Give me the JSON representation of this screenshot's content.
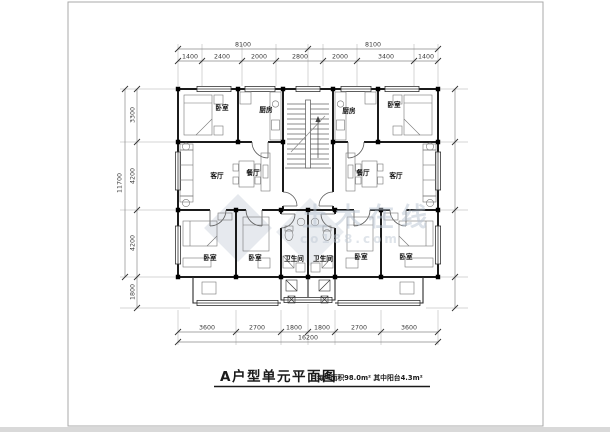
{
  "title": {
    "main": "A户型单元平面图",
    "note": "每户面积98.0m² 其中阳台4.3m²"
  },
  "watermark": {
    "brand": "土木在线",
    "site": "co188.com"
  },
  "dims": {
    "top_overall": [
      "8100",
      "8100"
    ],
    "top_segments": [
      "1400",
      "2400",
      "2000",
      "2800",
      "2000",
      "3400",
      "1400"
    ],
    "left_overall": "11700",
    "left_segments": [
      "3300",
      "4200",
      "4200",
      "1800"
    ],
    "bottom_segments": [
      "3600",
      "2700",
      "1800",
      "1800",
      "2700",
      "3600"
    ],
    "bottom_overall": "16200"
  },
  "rooms": {
    "left": {
      "bedroom_top": "卧室",
      "kitchen": "厨房",
      "living": "客厅",
      "dining": "餐厅",
      "bedroom_sw": "卧室",
      "bedroom_s": "卧室",
      "bath": "卫生间"
    },
    "right": {
      "bedroom_top": "卧室",
      "kitchen": "厨房",
      "living": "客厅",
      "dining": "餐厅",
      "bedroom_se": "卧室",
      "bedroom_s": "卧室",
      "bath": "卫生间"
    }
  }
}
